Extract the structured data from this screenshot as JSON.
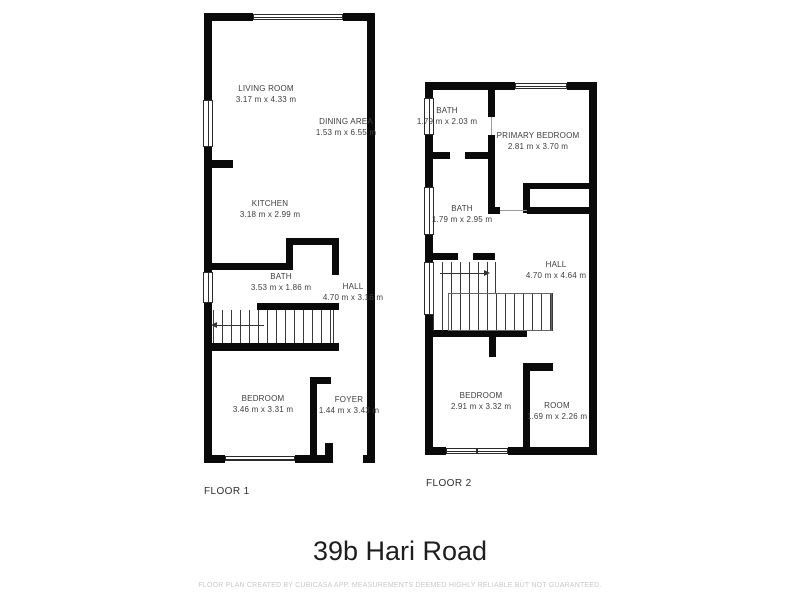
{
  "title": "39b Hari Road",
  "disclaimer": "FLOOR PLAN CREATED BY CUBICASA APP. MEASUREMENTS DEEMED HIGHLY RELIABLE BUT NOT GUARANTEED.",
  "colors": {
    "wall": "#0a0a0a",
    "label_text": "#3d3d3d",
    "disclaimer_text": "#c8c8c8"
  },
  "floor1": {
    "label": "FLOOR 1",
    "rooms": {
      "living_room": {
        "name": "LIVING ROOM",
        "dims": "3.17 m x 4.33 m"
      },
      "dining_area": {
        "name": "DINING AREA",
        "dims": "1.53 m x 6.55 m"
      },
      "kitchen": {
        "name": "KITCHEN",
        "dims": "3.18 m x 2.99 m"
      },
      "bath": {
        "name": "BATH",
        "dims": "3.53 m x 1.86 m"
      },
      "hall": {
        "name": "HALL",
        "dims": "4.70 m x 3.16 m"
      },
      "bedroom": {
        "name": "BEDROOM",
        "dims": "3.46 m x 3.31 m"
      },
      "foyer": {
        "name": "FOYER",
        "dims": "1.44 m x 3.43 m"
      }
    }
  },
  "floor2": {
    "label": "FLOOR 2",
    "rooms": {
      "bath_upper": {
        "name": "BATH",
        "dims": "1.79 m x 2.03 m"
      },
      "primary_bedroom": {
        "name": "PRIMARY BEDROOM",
        "dims": "2.81 m x 3.70 m"
      },
      "bath_lower": {
        "name": "BATH",
        "dims": "1.79 m x 2.95 m"
      },
      "hall": {
        "name": "HALL",
        "dims": "4.70 m x 4.64 m"
      },
      "bedroom": {
        "name": "BEDROOM",
        "dims": "2.91 m x 3.32 m"
      },
      "room": {
        "name": "ROOM",
        "dims": "1.69 m x 2.26 m"
      }
    }
  }
}
